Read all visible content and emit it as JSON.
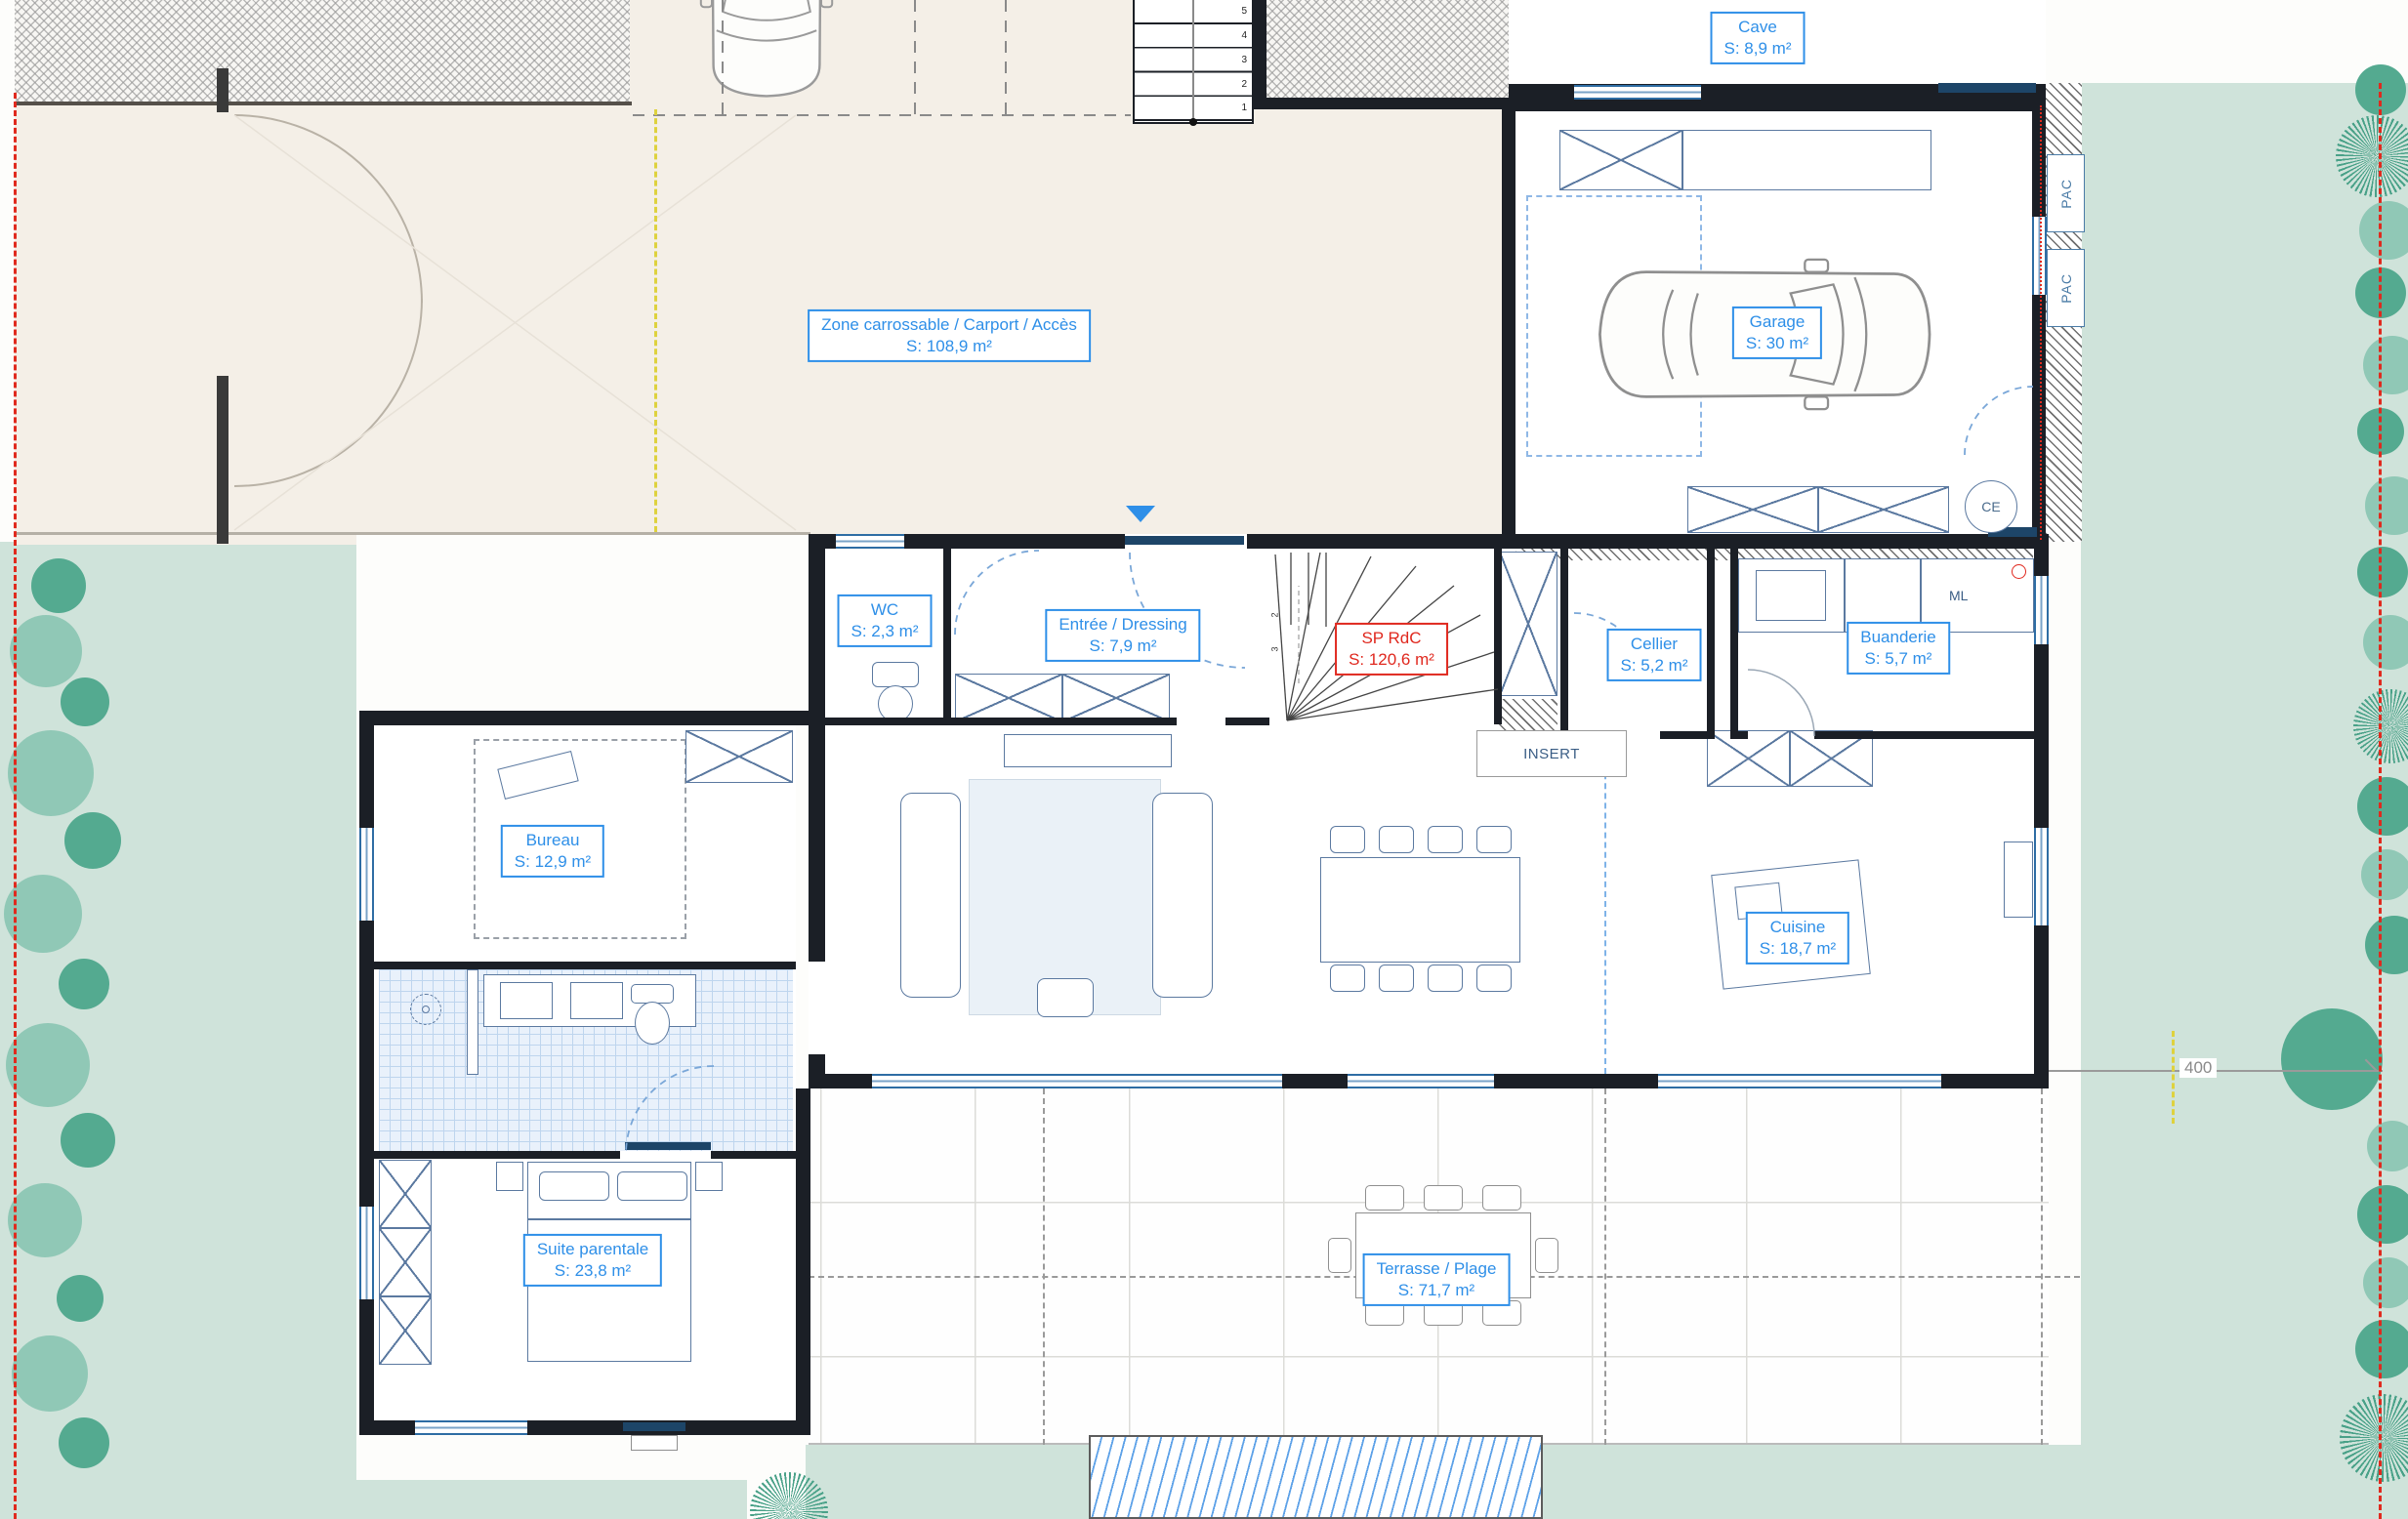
{
  "plan": {
    "rooms": [
      {
        "id": "cave",
        "name": "Cave",
        "area": "S: 8,9 m²"
      },
      {
        "id": "zone",
        "name": "Zone carrossable / Carport / Accès",
        "area": "S: 108,9 m²"
      },
      {
        "id": "garage",
        "name": "Garage",
        "area": "S: 30 m²"
      },
      {
        "id": "wc",
        "name": "WC",
        "area": "S: 2,3 m²"
      },
      {
        "id": "entree",
        "name": "Entrée / Dressing",
        "area": "S: 7,9 m²"
      },
      {
        "id": "sp-rdc",
        "name": "SP RdC",
        "area": "S: 120,6 m²"
      },
      {
        "id": "cellier",
        "name": "Cellier",
        "area": "S: 5,2 m²"
      },
      {
        "id": "buanderie",
        "name": "Buanderie",
        "area": "S: 5,7 m²"
      },
      {
        "id": "bureau",
        "name": "Bureau",
        "area": "S: 12,9 m²"
      },
      {
        "id": "cuisine",
        "name": "Cuisine",
        "area": "S: 18,7 m²"
      },
      {
        "id": "suite",
        "name": "Suite parentale",
        "area": "S: 23,8 m²"
      },
      {
        "id": "terrasse",
        "name": "Terrasse / Plage",
        "area": "S: 71,7 m²"
      }
    ],
    "annotations": {
      "pac": "PAC",
      "ml": "ML",
      "ce": "CE",
      "insert": "INSERT",
      "dimension_400": "400"
    },
    "stairs": {
      "exterior": [
        "5",
        "4",
        "3",
        "2",
        "1"
      ],
      "interior": [
        "2",
        "3"
      ]
    },
    "colors": {
      "label_blue": "#2e8fe8",
      "label_red": "#e0281e",
      "garden_green": "#cfe3da",
      "tree_green": "#54aa90",
      "driveway_beige": "#f4efe7",
      "wall_dark": "#1b1f26",
      "boundary_red": "#e02a1e",
      "axis_yellow": "#ded23e",
      "water_blue": "#5ea2e8",
      "tile_blue": "#bed5ee"
    }
  }
}
